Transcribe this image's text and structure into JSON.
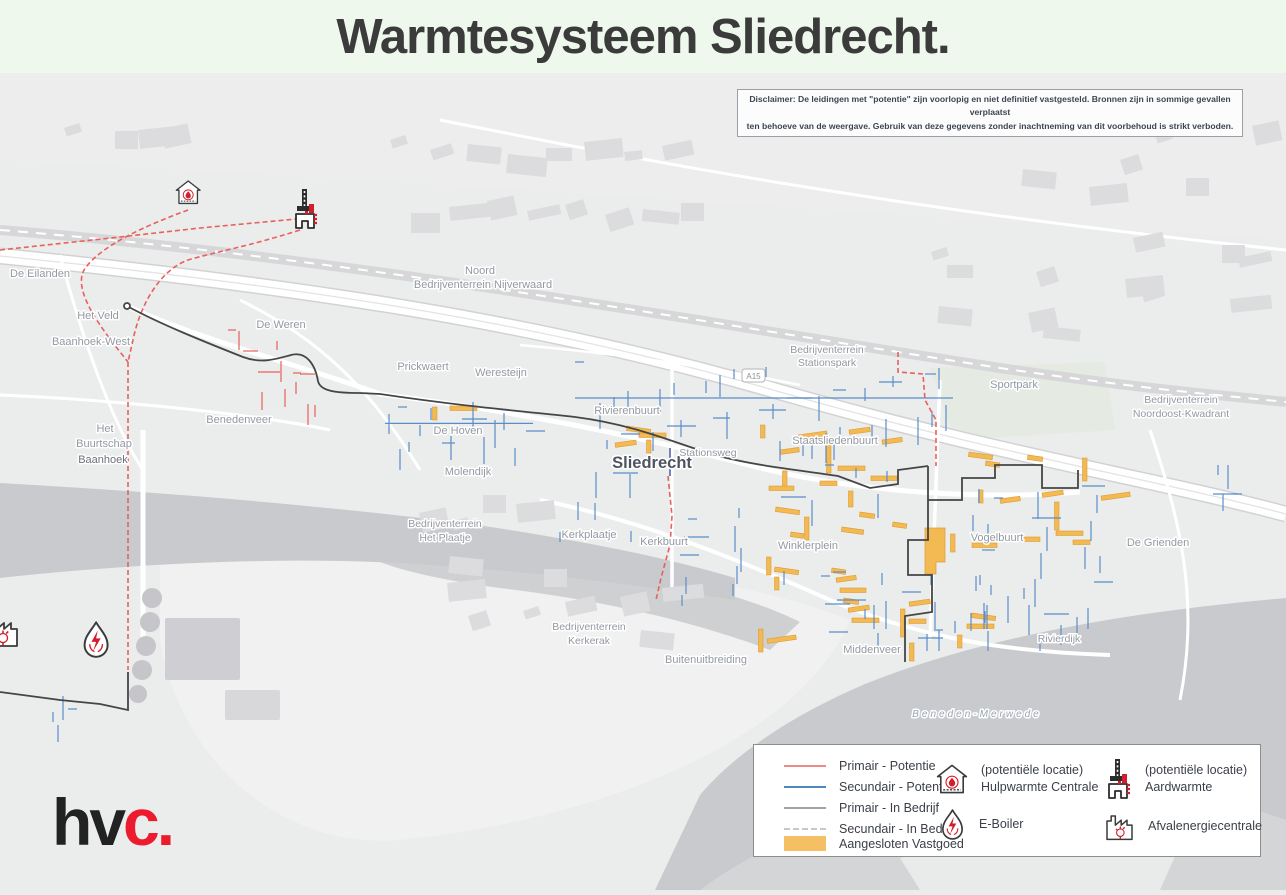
{
  "title": "Warmtesysteem Sliedrecht.",
  "logo": {
    "prefix": "hv",
    "accent": "c",
    "suffix": "."
  },
  "disclaimer": {
    "line1": "Disclaimer: De leidingen met \"potentie\" zijn voorlopig en niet definitief vastgesteld. Bronnen zijn in sommige gevallen verplaatst",
    "line2": "ten behoeve van de weergave. Gebruik van deze gegevens zonder inachtneming van dit voorbehoud is strikt verboden."
  },
  "legend": {
    "lines": [
      {
        "label": "Primair - Potentie",
        "color": "#ef8a84",
        "style": "solid"
      },
      {
        "label": "Secundair - Potentie",
        "color": "#4f86c0",
        "style": "solid"
      },
      {
        "label": "Primair - In Bedrijf",
        "color": "#a2a2a2",
        "style": "solid"
      },
      {
        "label": "Secundair - In Bedrijf",
        "color": "#c8c8c8",
        "style": "dashed"
      },
      {
        "label": "Aangesloten Vastgoed",
        "color": "#f5c064",
        "style": "fill"
      }
    ],
    "points": [
      {
        "icon": "hulpwarmte-house-icon",
        "line1": "(potentiële locatie)",
        "line2": "Hulpwarmte Centrale"
      },
      {
        "icon": "aardwarmte-derrick-icon",
        "line1": "(potentiële locatie)",
        "line2": "Aardwarmte"
      },
      {
        "icon": "eboiler-flame-icon",
        "line1": "E-Boiler",
        "line2": ""
      },
      {
        "icon": "afvalenergiecentrale-factory-icon",
        "line1": "Afvalenergiecentrale",
        "line2": ""
      }
    ]
  },
  "map": {
    "highway_shield": "A15",
    "labels": [
      {
        "text": "De Eilanden"
      },
      {
        "text": "Het Veld"
      },
      {
        "text": "Baanhoek-West"
      },
      {
        "text": "De Weren"
      },
      {
        "text": "Prickwaert"
      },
      {
        "text": "Weresteijn"
      },
      {
        "text": "Benedenveer"
      },
      {
        "text": "Het"
      },
      {
        "text": "Buurtschap"
      },
      {
        "text": "Baanhoek"
      },
      {
        "text": "Noord"
      },
      {
        "text": "Bedrijventerrein Nijverwaard"
      },
      {
        "text": "Rivierenbuurt"
      },
      {
        "text": "De Hoven"
      },
      {
        "text": "Molendijk"
      },
      {
        "text": "Sliedrecht"
      },
      {
        "text": "Stationsweg"
      },
      {
        "text": "Bedrijventerrein"
      },
      {
        "text": "Stationspark"
      },
      {
        "text": "Sportpark"
      },
      {
        "text": "Bedrijventerrein"
      },
      {
        "text": "Noordoost-Kwadrant"
      },
      {
        "text": "Staatsliedenbuurt"
      },
      {
        "text": "Winklerplein"
      },
      {
        "text": "Vogelbuurt"
      },
      {
        "text": "De Grienden"
      },
      {
        "text": "Bedrijventerrein"
      },
      {
        "text": "Het Plaatje"
      },
      {
        "text": "Kerkplaatje"
      },
      {
        "text": "Kerkbuurt"
      },
      {
        "text": "Bedrijventerrein"
      },
      {
        "text": "Kerkerak"
      },
      {
        "text": "Buitenuitbreiding"
      },
      {
        "text": "Middenveer"
      },
      {
        "text": "Rivierdijk"
      },
      {
        "text": "Beneden-Merwede"
      }
    ]
  },
  "colors": {
    "primair_potentie": "#e8615c",
    "secundair_potentie": "#5b8dc8",
    "primair_in_bedrijf": "#454545",
    "secundair_in_bedrijf": "#c8c8c8",
    "aangesloten_vastgoed": "#f3b953",
    "title_background": "#eef8ec",
    "water": "#c9cacd",
    "land": "#ebecec",
    "logo_accent": "#ec1b2e"
  }
}
